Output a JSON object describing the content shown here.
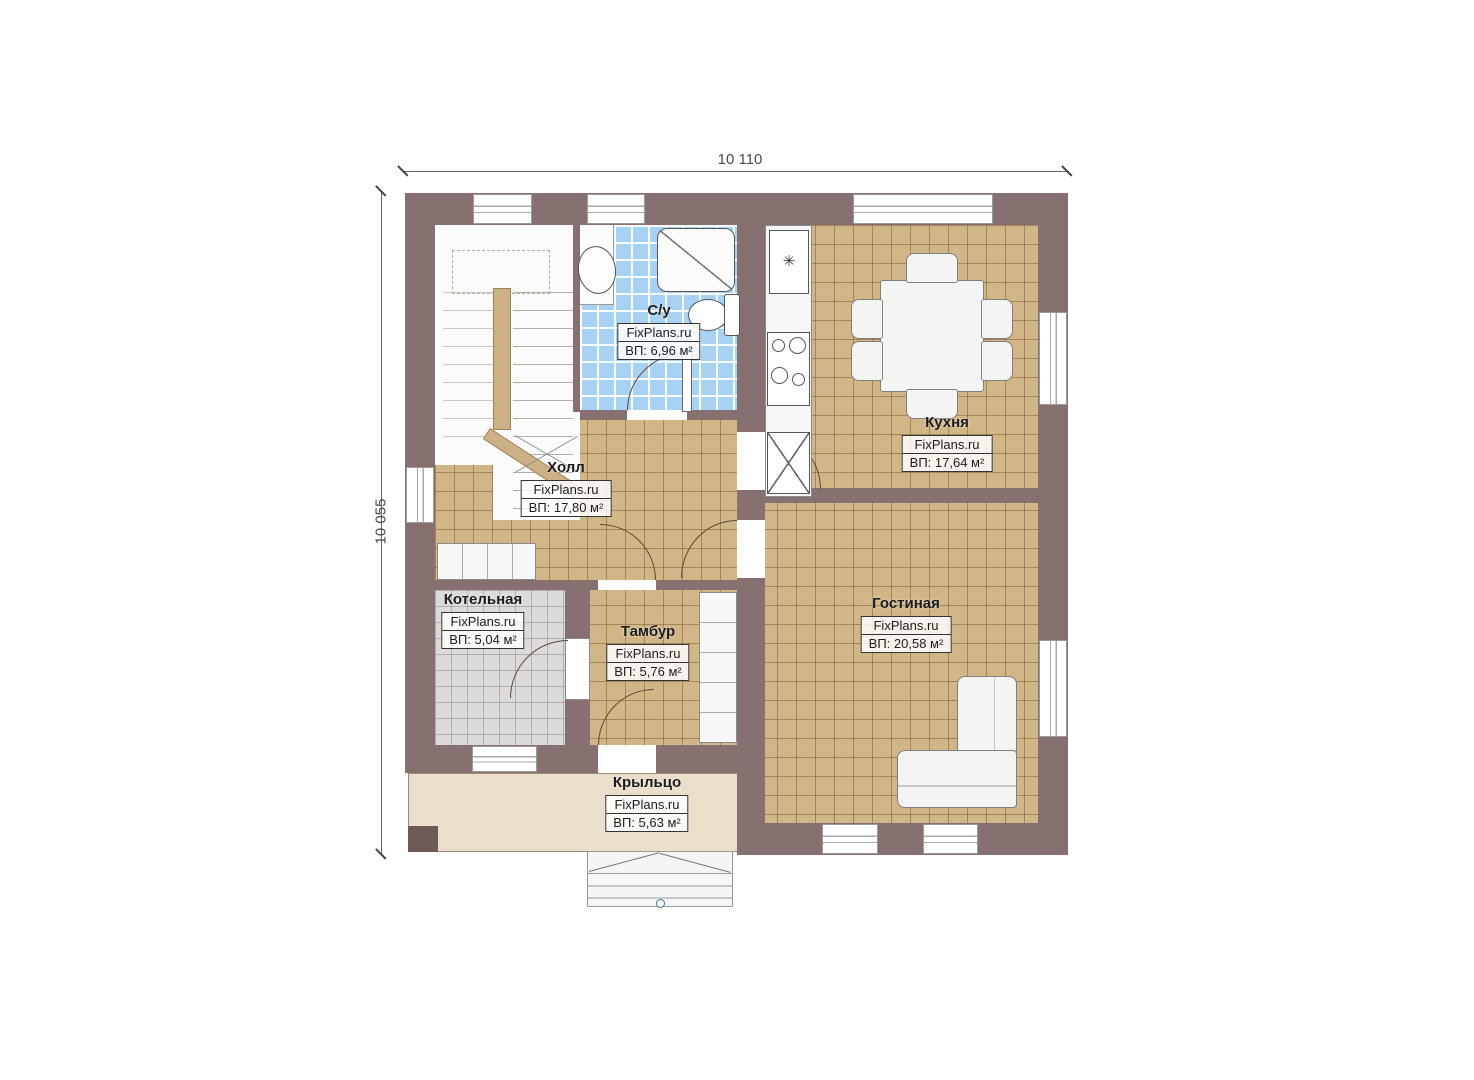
{
  "dimensions": {
    "width_label": "10 110",
    "height_label": "10 055"
  },
  "brand": "FixPlans.ru",
  "rooms": [
    {
      "id": "su",
      "name": "С/у",
      "brand": "FixPlans.ru",
      "area": "ВП: 6,96 м²"
    },
    {
      "id": "kitchen",
      "name": "Кухня",
      "brand": "FixPlans.ru",
      "area": "ВП: 17,64 м²"
    },
    {
      "id": "hall",
      "name": "Холл",
      "brand": "FixPlans.ru",
      "area": "ВП: 17,80 м²"
    },
    {
      "id": "boiler",
      "name": "Котельная",
      "brand": "FixPlans.ru",
      "area": "ВП: 5,04 м²"
    },
    {
      "id": "tambour",
      "name": "Тамбур",
      "brand": "FixPlans.ru",
      "area": "ВП: 5,76 м²"
    },
    {
      "id": "living",
      "name": "Гостиная",
      "brand": "FixPlans.ru",
      "area": "ВП: 20,58 м²"
    },
    {
      "id": "porch",
      "name": "Крыльцо",
      "brand": "FixPlans.ru",
      "area": "ВП: 5,63 м²"
    }
  ],
  "icons": {
    "fridge_snowflake": "✳"
  },
  "colors": {
    "wall": "#877170",
    "tile_tan": "#d1b687",
    "tile_blue": "#a8d2f4",
    "tile_gray": "#dcdbd9",
    "porch": "#e9dfca",
    "marker_blue": "#4a6fa5"
  }
}
